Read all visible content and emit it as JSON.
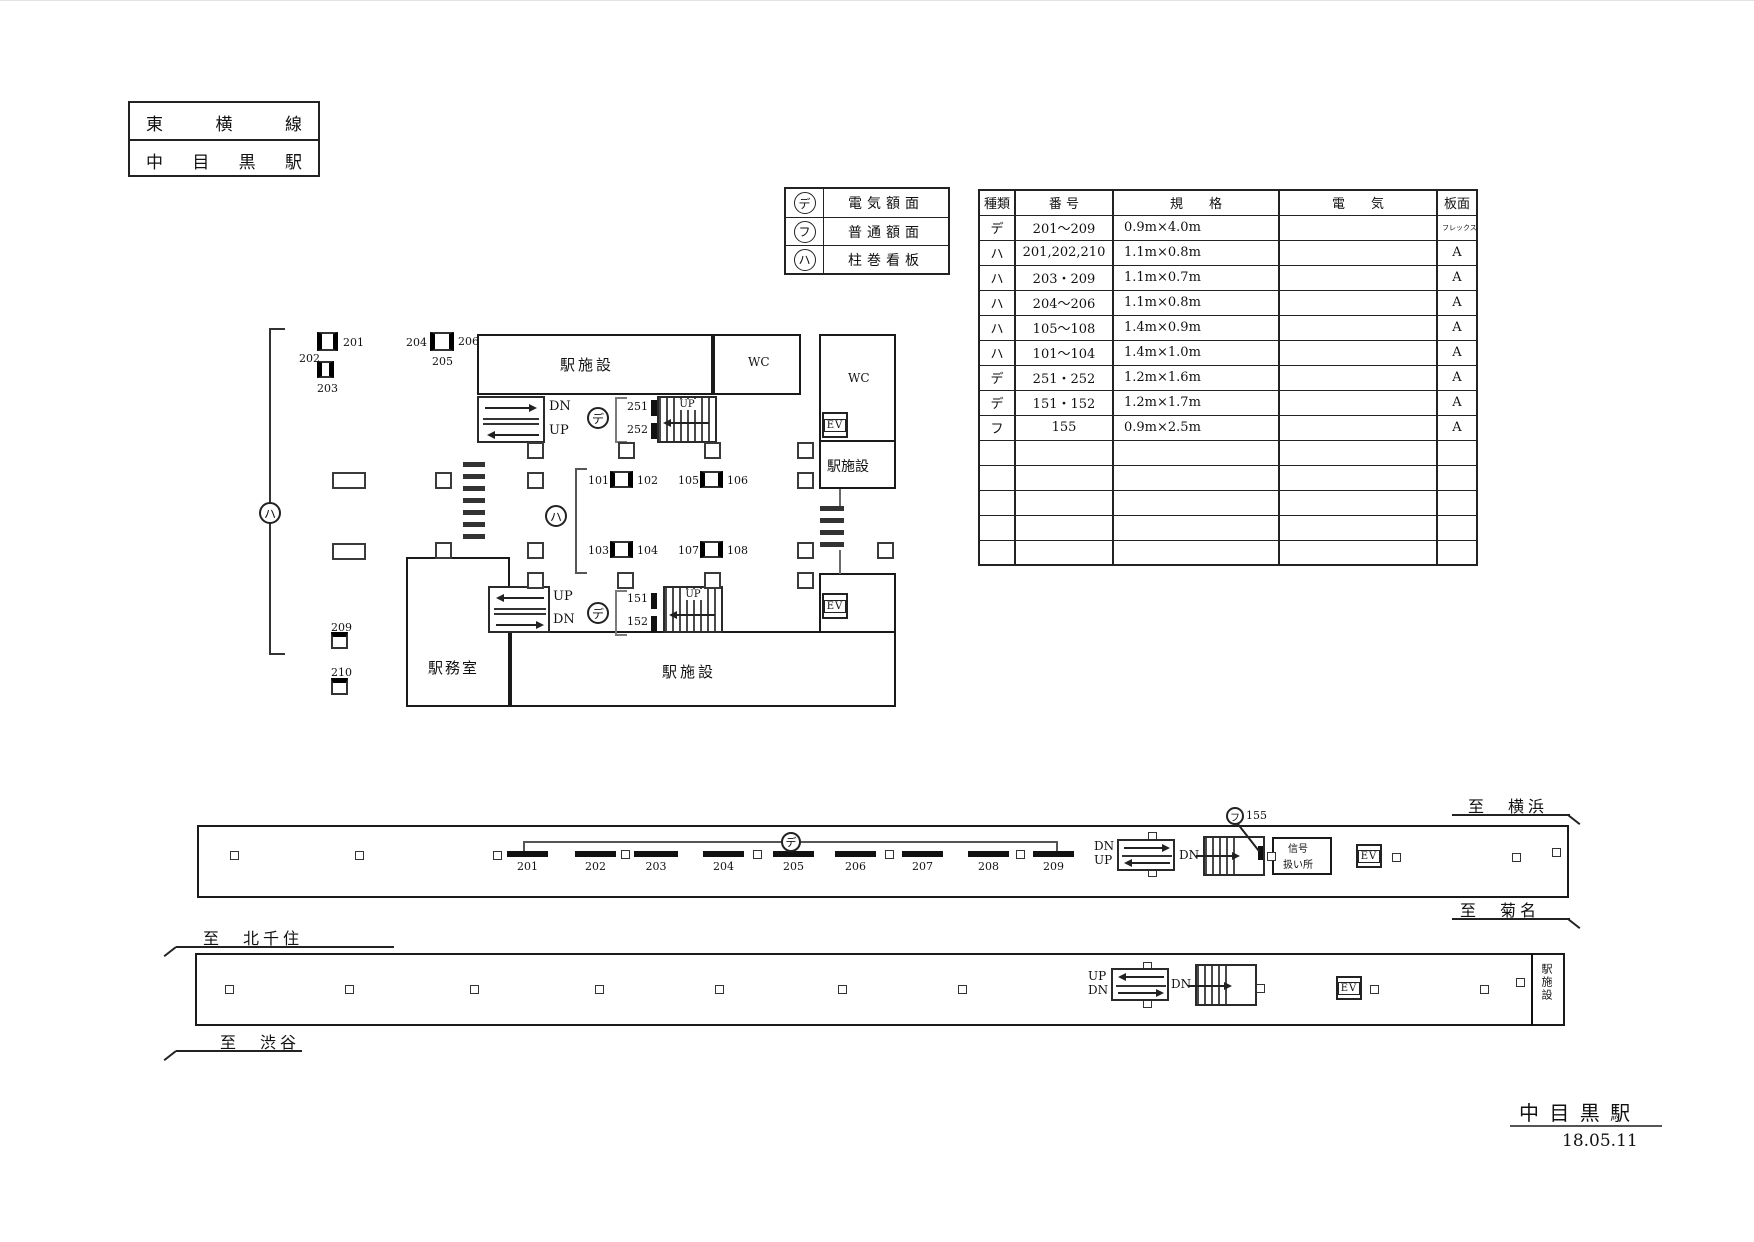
{
  "title_block": {
    "line_name": "東横線",
    "station_name": "中目黒駅"
  },
  "legend": {
    "rows": [
      {
        "symbol": "デ",
        "label": "電気額面"
      },
      {
        "symbol": "フ",
        "label": "普通額面"
      },
      {
        "symbol": "ハ",
        "label": "柱巻看板"
      }
    ]
  },
  "spec_table": {
    "headers": [
      "種類",
      "番 号",
      "規　　格",
      "電　　気",
      "板面"
    ],
    "rows": [
      [
        "デ",
        "201〜209",
        "0.9m×4.0m",
        "",
        "フレックスシート"
      ],
      [
        "ハ",
        "201,202,210",
        "1.1m×0.8m",
        "",
        "A"
      ],
      [
        "ハ",
        "203・209",
        "1.1m×0.7m",
        "",
        "A"
      ],
      [
        "ハ",
        "204〜206",
        "1.1m×0.8m",
        "",
        "A"
      ],
      [
        "ハ",
        "105〜108",
        "1.4m×0.9m",
        "",
        "A"
      ],
      [
        "ハ",
        "101〜104",
        "1.4m×1.0m",
        "",
        "A"
      ],
      [
        "デ",
        "251・252",
        "1.2m×1.6m",
        "",
        "A"
      ],
      [
        "デ",
        "151・152",
        "1.2m×1.7m",
        "",
        "A"
      ],
      [
        "フ",
        "155",
        "0.9m×2.5m",
        "",
        "A"
      ]
    ]
  },
  "plan": {
    "room_facility": "駅施設",
    "room_office": "駅務室",
    "room_wc": "WC",
    "ev": "EV",
    "up": "UP",
    "dn": "DN",
    "sym_de": "デ",
    "sym_fu": "フ",
    "sym_ha": "ハ",
    "signs": {
      "n201": "201",
      "n202": "202",
      "n203": "203",
      "n204": "204",
      "n205": "205",
      "n206": "206",
      "n209": "209",
      "n210": "210",
      "n251": "251",
      "n252": "252",
      "n151": "151",
      "n152": "152",
      "n101": "101",
      "n102": "102",
      "n103": "103",
      "n104": "104",
      "n105": "105",
      "n106": "106",
      "n107": "107",
      "n108": "108"
    }
  },
  "platform_upper": {
    "bars": [
      "201",
      "202",
      "203",
      "204",
      "205",
      "206",
      "207",
      "208",
      "209"
    ],
    "group_symbol": "デ",
    "sign155_symbol": "フ",
    "sign155_number": "155",
    "signal_room_line1": "信号",
    "signal_room_line2": "扱い所",
    "ev": "EV",
    "up": "UP",
    "dn": "DN",
    "dest_top": "至　横浜",
    "dest_bottom": "至　菊名"
  },
  "platform_lower": {
    "dest_top": "至　北千住",
    "dest_bottom": "至　渋谷",
    "ev": "EV",
    "up": "UP",
    "dn": "DN",
    "end_room": "駅施設"
  },
  "footer": {
    "station": "中 目 黒 駅",
    "date": "18.05.11"
  }
}
